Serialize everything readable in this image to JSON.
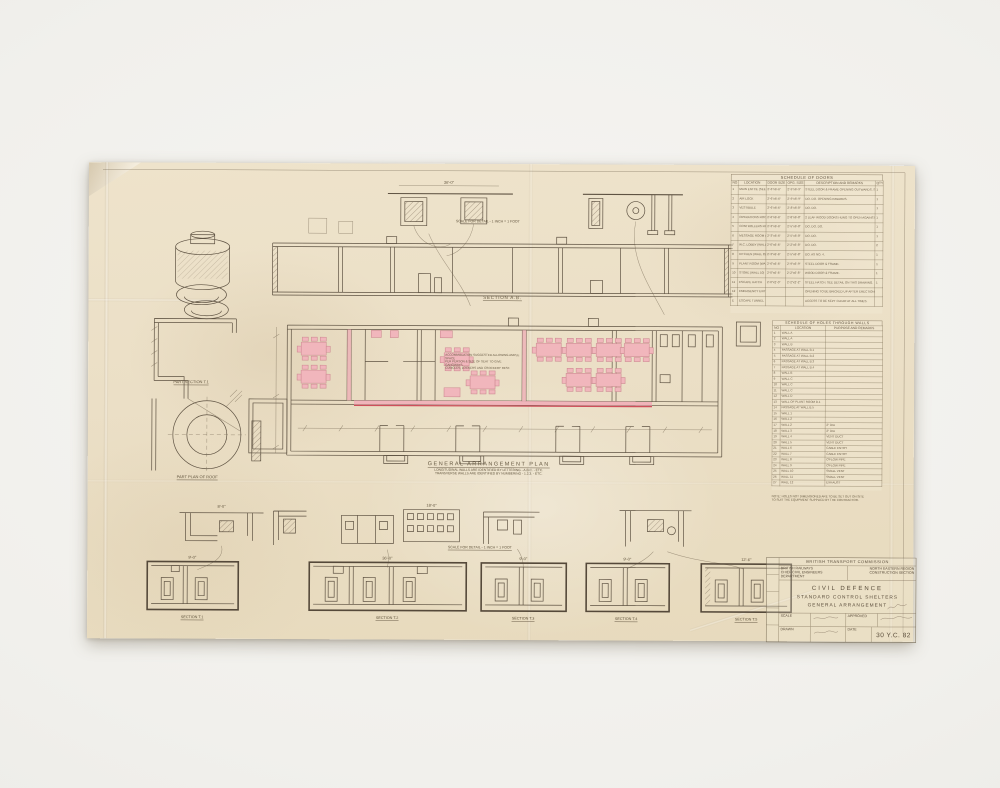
{
  "labels": {
    "section_ab": "SECTION A.B.",
    "ga_title": "GENERAL ARRANGEMENT PLAN",
    "ga_note1": "LONGITUDINAL WALLS ARE IDENTIFIED BY LETTERING - A.B.C. - ETC.",
    "ga_note2": "TRANSVERSE WALLS ARE IDENTIFIED BY NUMBERING - 1.2.3. - ETC.",
    "part_section": "PART SECTION T.1",
    "part_plan_roof": "PART PLAN OF ROOF",
    "scale_detail_top": "SCALE FOR DETAIL - 1 INCH = 1 FOOT",
    "scale_detail_bottom": "SCALE FOR DETAIL - 1 INCH = 1 FOOT",
    "annotation1": "ACCOMMODATION SUGGESTED ALLOWING AMPLE SPACE",
    "annotation2": "PER PERSON & SIZE OF SEAT TO GIVE GANGWAYS,",
    "annotation3": "CUBICLES, LOCKERS AND CROCKERY REST."
  },
  "dims": {
    "w36": "36'-0\"",
    "w18": "18'-0\"",
    "w12": "12'-6\"",
    "w9": "9'-0\"",
    "w8": "8'-0\""
  },
  "sections": [
    {
      "label": "SECTION T.1"
    },
    {
      "label": "SECTION T.2"
    },
    {
      "label": "SECTION T.3"
    },
    {
      "label": "SECTION T.4"
    },
    {
      "label": "SECTION T.5"
    }
  ],
  "doors_schedule": {
    "title": "SCHEDULE OF DOORS",
    "headers": [
      "NO",
      "LOCATION",
      "DOOR SIZE",
      "OPG. SIZE",
      "DESCRIPTION AND REMARKS",
      "QTY"
    ],
    "rows": [
      {
        "no": "1",
        "loc": "MAIN ENTCE (SEE DETAIL)",
        "size": "2'-6\"x6'-6\"",
        "opg": "2'-9\"x6'-9\"",
        "remarks": "STEEL DOOR & FRAME OPENING OUTWARDS. SEE DETAIL THIS DRG.",
        "qty": "1"
      },
      {
        "no": "2",
        "loc": "AIR LOCK",
        "size": "2'-6\"x6'-6\"",
        "opg": "2'-9\"x6'-9\"",
        "remarks": "DO. DO. OPENING INWARDS.",
        "qty": "1"
      },
      {
        "no": "3",
        "loc": "VESTIBULE",
        "size": "2'-6\"x6'-6\"",
        "opg": "2'-8\"x6'-8\"",
        "remarks": "DO. DO.",
        "qty": "1"
      },
      {
        "no": "4",
        "loc": "OPERATIONS ROOM (WALL 3)",
        "size": "2'-6\"x6'-6\"",
        "opg": "2'-8\"x6'-8\"",
        "remarks": "2 LEAF WOOD DOORS HUNG TO OPEN AGAINST WALL.",
        "qty": "1"
      },
      {
        "no": "5",
        "loc": "CONTROLLERS ROOM (WALL 4)",
        "size": "2'-3\"x6'-6\"",
        "opg": "2'-5\"x6'-8\"",
        "remarks": "DO. DO. DO.",
        "qty": "1"
      },
      {
        "no": "6",
        "loc": "MESSAGE ROOM (WALL 5)",
        "size": "2'-3\"x6'-6\"",
        "opg": "2'-5\"x6'-8\"",
        "remarks": "DO. DO.",
        "qty": "1"
      },
      {
        "no": "7",
        "loc": "W.C. LOBBY (WALL 7)",
        "size": "2'-0\"x6'-6\"",
        "opg": "2'-2\"x6'-8\"",
        "remarks": "DO. DO.",
        "qty": "2"
      },
      {
        "no": "8",
        "loc": "KITCHEN (WALL 8)",
        "size": "2'-3\"x6'-6\"",
        "opg": "2'-5\"x6'-8\"",
        "remarks": "DO. AS NO. 4.",
        "qty": "1"
      },
      {
        "no": "9",
        "loc": "PLANT ROOM (WALL 9)",
        "size": "2'-6\"x6'-6\"",
        "opg": "2'-9\"x6'-9\"",
        "remarks": "STEEL DOOR & FRAME.",
        "qty": "1"
      },
      {
        "no": "10",
        "loc": "STORE (WALL 10)",
        "size": "2'-0\"x6'-6\"",
        "opg": "2'-2\"x6'-8\"",
        "remarks": "WOOD DOOR & FRAME.",
        "qty": "1"
      },
      {
        "no": "11",
        "loc": "ESCAPE HATCH",
        "size": "2'-0\"x2'-0\"",
        "opg": "2'-2\"x2'-2\"",
        "remarks": "STEEL HATCH. SEE DETAIL ON THIS DRAWING.",
        "qty": "1"
      },
      {
        "no": "12",
        "loc": "EMERGENCY EXIT",
        "size": "",
        "opg": "",
        "remarks": "OPENING TO BE BRICKED UP AFTER ERECTION.",
        "qty": ""
      },
      {
        "no": "E",
        "loc": "ESCAPE TUNNEL",
        "size": "",
        "opg": "",
        "remarks": "ACCESS TO BE KEPT CLEAR AT ALL TIMES.",
        "qty": ""
      }
    ]
  },
  "holes_schedule": {
    "title": "SCHEDULE OF HOLES THROUGH WALLS",
    "headers": [
      "NO",
      "LOCATION",
      "PURPOSE AND REMARKS"
    ],
    "rows": [
      {
        "no": "1",
        "loc": "WALL A",
        "purpose": ""
      },
      {
        "no": "2",
        "loc": "WALL A",
        "purpose": ""
      },
      {
        "no": "3",
        "loc": "WALL B",
        "purpose": ""
      },
      {
        "no": "4",
        "loc": "PASSAGE AT WALL B.1",
        "purpose": ""
      },
      {
        "no": "5",
        "loc": "PASSAGE AT WALL B.2",
        "purpose": ""
      },
      {
        "no": "6",
        "loc": "PASSAGE AT WALL B.3",
        "purpose": ""
      },
      {
        "no": "7",
        "loc": "PASSAGE AT WALL B.4",
        "purpose": ""
      },
      {
        "no": "8",
        "loc": "WALL B",
        "purpose": ""
      },
      {
        "no": "9",
        "loc": "WALL C",
        "purpose": ""
      },
      {
        "no": "10",
        "loc": "WALL C",
        "purpose": ""
      },
      {
        "no": "11",
        "loc": "WALL C",
        "purpose": ""
      },
      {
        "no": "12",
        "loc": "WALL D",
        "purpose": ""
      },
      {
        "no": "13",
        "loc": "WALL OF PLANT ROOM B.1",
        "purpose": ""
      },
      {
        "no": "14",
        "loc": "PASSAGE AT WALL B.5",
        "purpose": ""
      },
      {
        "no": "15",
        "loc": "WALL 1",
        "purpose": ""
      },
      {
        "no": "16",
        "loc": "WALL 2",
        "purpose": ""
      },
      {
        "no": "17",
        "loc": "WALL 2",
        "purpose": "2\" DIA"
      },
      {
        "no": "18",
        "loc": "WALL 3",
        "purpose": "2\" DIA"
      },
      {
        "no": "19",
        "loc": "WALL 4",
        "purpose": "VENT DUCT"
      },
      {
        "no": "20",
        "loc": "WALL 5",
        "purpose": "VENT DUCT"
      },
      {
        "no": "21",
        "loc": "WALL 6",
        "purpose": "CABLE ENTRY"
      },
      {
        "no": "22",
        "loc": "WALL 7",
        "purpose": "CABLE ENTRY"
      },
      {
        "no": "23",
        "loc": "WALL 8",
        "purpose": "O'FLOW PIPE"
      },
      {
        "no": "24",
        "loc": "WALL 9",
        "purpose": "O'FLOW PIPE"
      },
      {
        "no": "25",
        "loc": "WALL 10",
        "purpose": "SMALL VENT"
      },
      {
        "no": "26",
        "loc": "WALL 11",
        "purpose": "SMALL VENT"
      },
      {
        "no": "27",
        "loc": "WALL 12",
        "purpose": "EXHAUST"
      }
    ],
    "note1": "NOTE: HOLES NOT DIMENSIONED ARE TO BE SET OUT ON SITE",
    "note2": "TO SUIT THE EQUIPMENT SUPPLIED BY THE CONTRACTOR."
  },
  "title_block": {
    "commission": "BRITISH TRANSPORT COMMISSION",
    "org_left1": "BRITISH RAILWAYS",
    "org_left2": "CHIEF CIVIL ENGINEERS DEPARTMENT",
    "org_right1": "NORTH EASTERN REGION",
    "org_right2": "CONSTRUCTION SECTION",
    "title1": "CIVIL DEFENCE",
    "title2": "STANDARD CONTROL SHELTERS",
    "title3": "GENERAL ARRANGEMENT",
    "scale_label": "SCALE",
    "drawn_label": "DRAWN",
    "approved_label": "APPROVED",
    "date_label": "DATE",
    "drg_no": "30 Y.C. 82"
  },
  "colors": {
    "paper": "#ebdfc6",
    "mount": "#f1f0ec",
    "ink": "#5f5343",
    "pink_highlight": "#f1b6bc",
    "red_line": "#cf4f5b"
  }
}
